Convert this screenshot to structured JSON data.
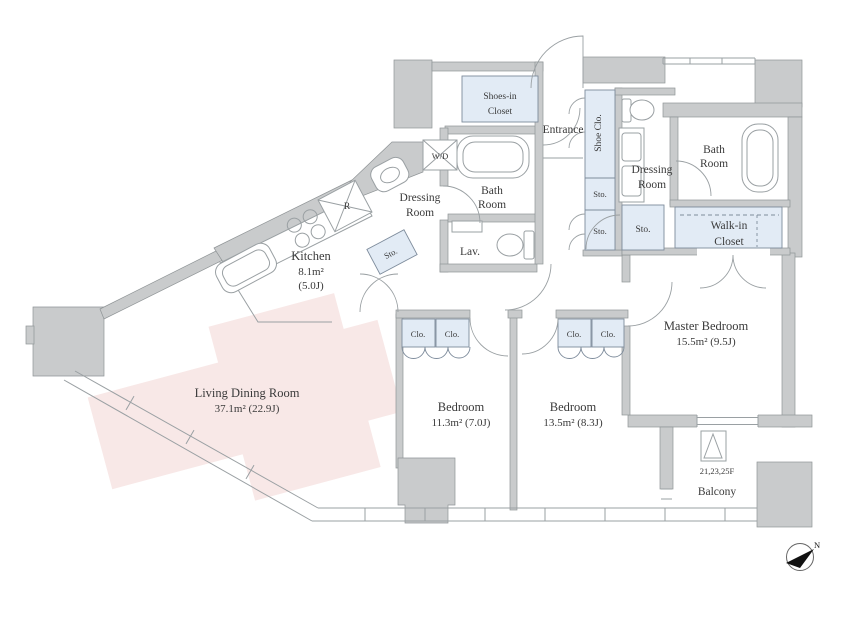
{
  "plan": {
    "rooms": {
      "living": {
        "name": "Living Dining Room",
        "area": "37.1m²  (22.9J)"
      },
      "kitchen": {
        "name": "Kitchen",
        "area_m": "8.1m²",
        "area_j": "(5.0J)"
      },
      "bedroom1": {
        "name": "Bedroom",
        "area": "11.3m²  (7.0J)"
      },
      "bedroom2": {
        "name": "Bedroom",
        "area": "13.5m²  (8.3J)"
      },
      "master": {
        "name": "Master Bedroom",
        "area": "15.5m²  (9.5J)"
      },
      "bath1": {
        "line1": "Bath",
        "line2": "Room"
      },
      "bath2": {
        "line1": "Bath",
        "line2": "Room"
      },
      "dressing1": {
        "line1": "Dressing",
        "line2": "Room"
      },
      "dressing2": {
        "line1": "Dressing",
        "line2": "Room"
      },
      "lav": {
        "name": "Lav."
      },
      "entrance": {
        "name": "Entrance"
      },
      "shoes_in_closet": {
        "line1": "Shoes-in",
        "line2": "Closet"
      },
      "shoe_closet": {
        "name": "Shoe Clo."
      },
      "walk_in_closet": {
        "line1": "Walk-in",
        "line2": "Closet"
      },
      "balcony": {
        "name": "Balcony",
        "floors": "21,23,25F"
      }
    },
    "labels": {
      "sto": "Sto.",
      "clo": "Clo.",
      "wd": "W/D",
      "fridge": "R",
      "north": "N"
    },
    "colors": {
      "wall": "#c9cbcc",
      "closet": "#e2ebf5",
      "living_highlight": "#f8e8e7",
      "line": "#9aa0a3",
      "text": "#3a3a3a"
    }
  }
}
